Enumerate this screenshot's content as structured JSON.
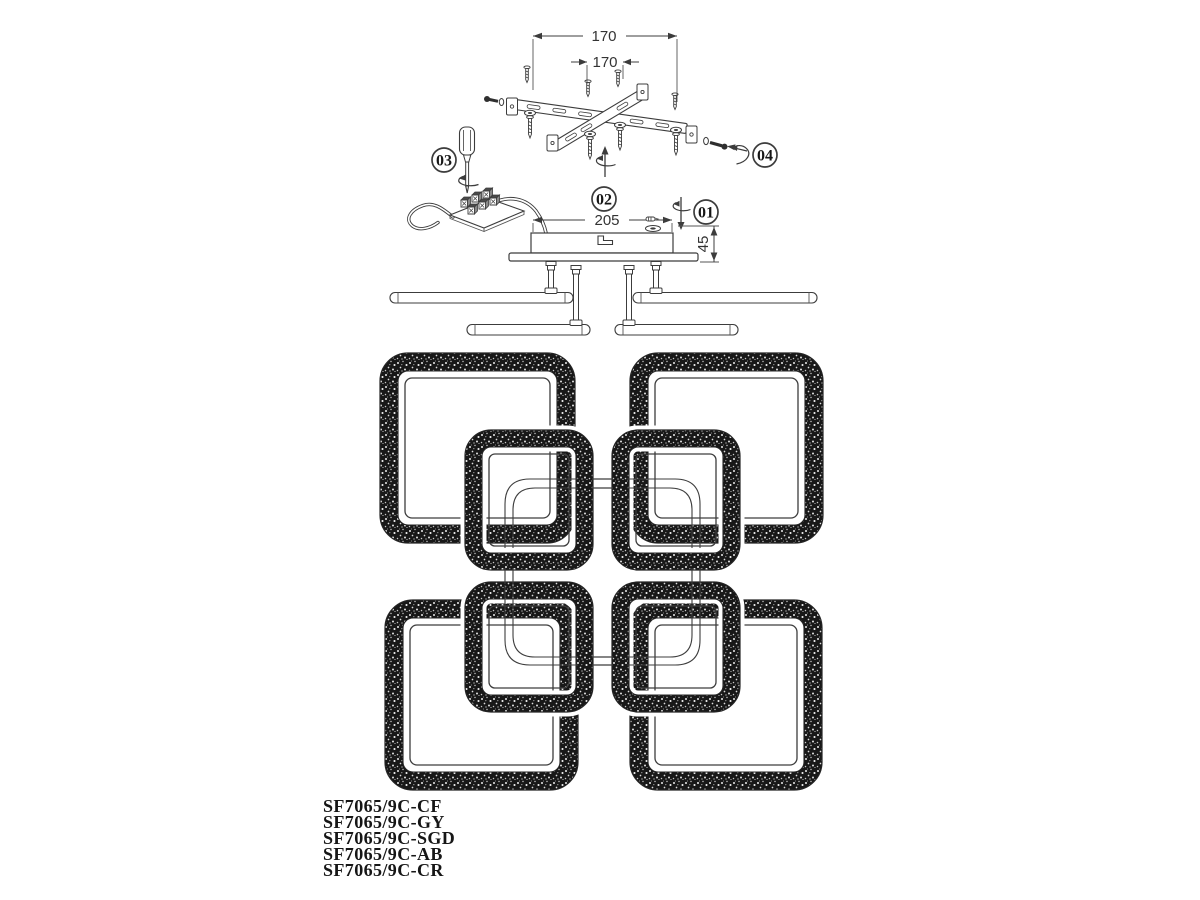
{
  "diagram": {
    "dimensions": {
      "bracket_spacing_outer": "170",
      "bracket_spacing_inner": "170",
      "canopy_width": "205",
      "canopy_height": "45"
    },
    "steps": [
      {
        "id": "01"
      },
      {
        "id": "02"
      },
      {
        "id": "03"
      },
      {
        "id": "04"
      }
    ],
    "model_numbers": [
      "SF7065/9C-CF",
      "SF7065/9C-GY",
      "SF7065/9C-SGD",
      "SF7065/9C-AB",
      "SF7065/9C-CR"
    ],
    "colors": {
      "line": "#3c3c3c",
      "ring": "#181818",
      "text": "#1c1c1c",
      "background": "#ffffff"
    }
  }
}
